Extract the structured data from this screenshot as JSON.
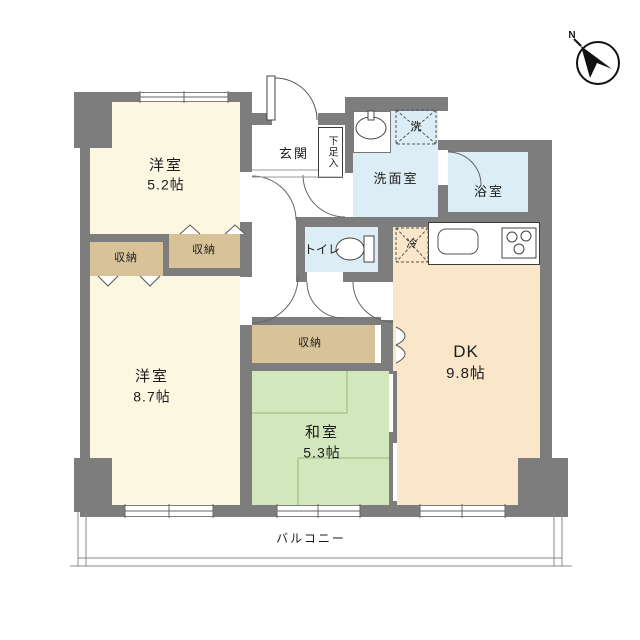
{
  "compass": {
    "label": "N"
  },
  "rooms": {
    "western_room_1": {
      "name": "洋室",
      "size": "5.2帖"
    },
    "western_room_2": {
      "name": "洋室",
      "size": "8.7帖"
    },
    "japanese_room": {
      "name": "和室",
      "size": "5.3帖"
    },
    "dining_kitchen": {
      "name": "DK",
      "size": "9.8帖"
    },
    "entrance": {
      "name": "玄関"
    },
    "shoe_cabinet": {
      "name": "下足入"
    },
    "washroom": {
      "name": "洗面室"
    },
    "bathroom": {
      "name": "浴室"
    },
    "toilet": {
      "name": "トイレ"
    },
    "balcony": {
      "name": "バルコニー"
    }
  },
  "closets": {
    "closet_1": {
      "name": "収納"
    },
    "closet_2": {
      "name": "収納"
    },
    "closet_3": {
      "name": "収納"
    }
  },
  "appliance_spaces": {
    "washer_space": {
      "name": "洗"
    },
    "refrigerator_space": {
      "name": "冷"
    }
  },
  "colors": {
    "wall": "#7d7d7d",
    "western_room": "#fbf7e1",
    "closet": "#d8c298",
    "wet_area": "#dcedf5",
    "japanese_room": "#d2e7bb",
    "dining_kitchen": "#fae6c8"
  }
}
